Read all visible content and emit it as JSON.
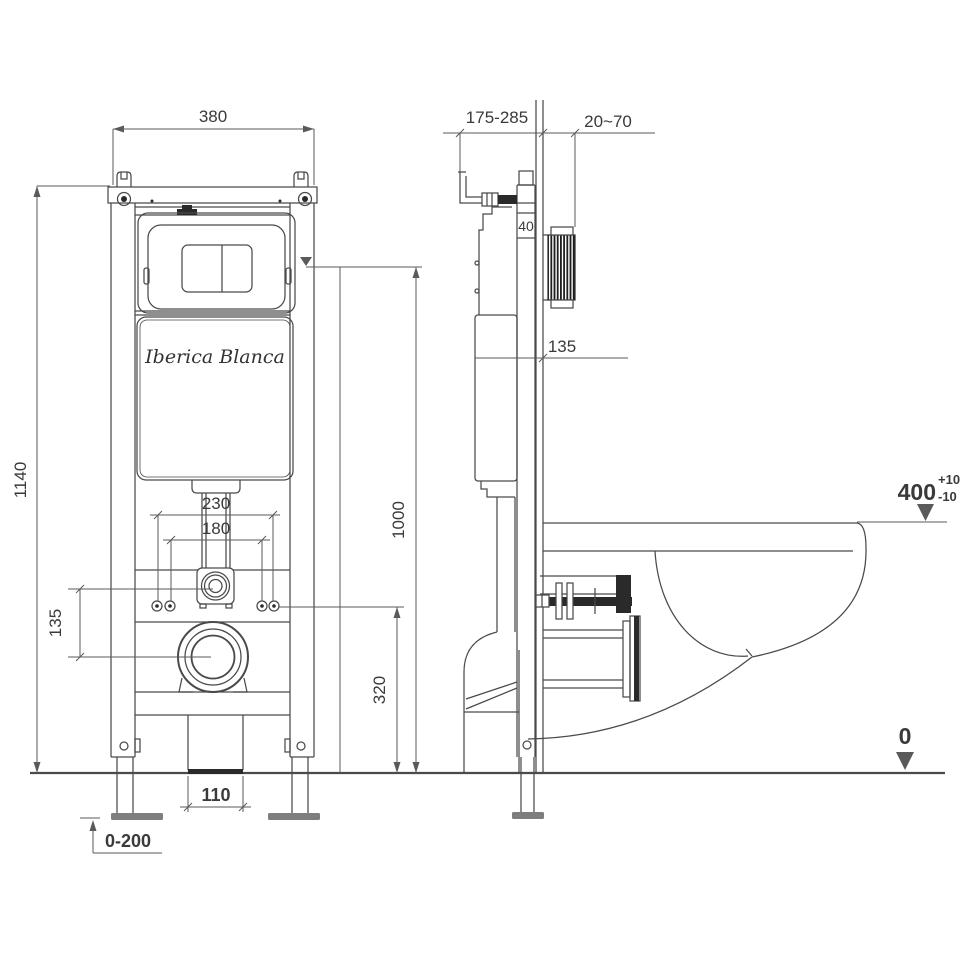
{
  "title": "Wall-hung WC concealed cistern frame installation drawing",
  "brand": "Iberica Blanca",
  "front_view": {
    "frame_width": "380",
    "frame_height": "1140",
    "flush_plate_center_height": "1000",
    "bolt_span_outer": "230",
    "bolt_span_inner": "180",
    "inlet_outlet_offset": "135",
    "bolt_height": "320",
    "outlet_box_width": "110",
    "feet_adjust_range": "0-200"
  },
  "side_view": {
    "bracket_depth_range": "175-285",
    "wall_finish_range": "20~70",
    "rail_depth": "40",
    "tank_level_mark": "135",
    "rim_height": "400",
    "rim_tolerance_plus": "+10",
    "rim_tolerance_minus": "-10",
    "floor_datum": "0"
  },
  "colors": {
    "background": "#ffffff",
    "line": "#4a4a4a",
    "dimension_line": "#5a5a5a",
    "text": "#3a3a3a",
    "hatch": "#2a2a2a",
    "foot_plate": "#7e7e7e"
  }
}
